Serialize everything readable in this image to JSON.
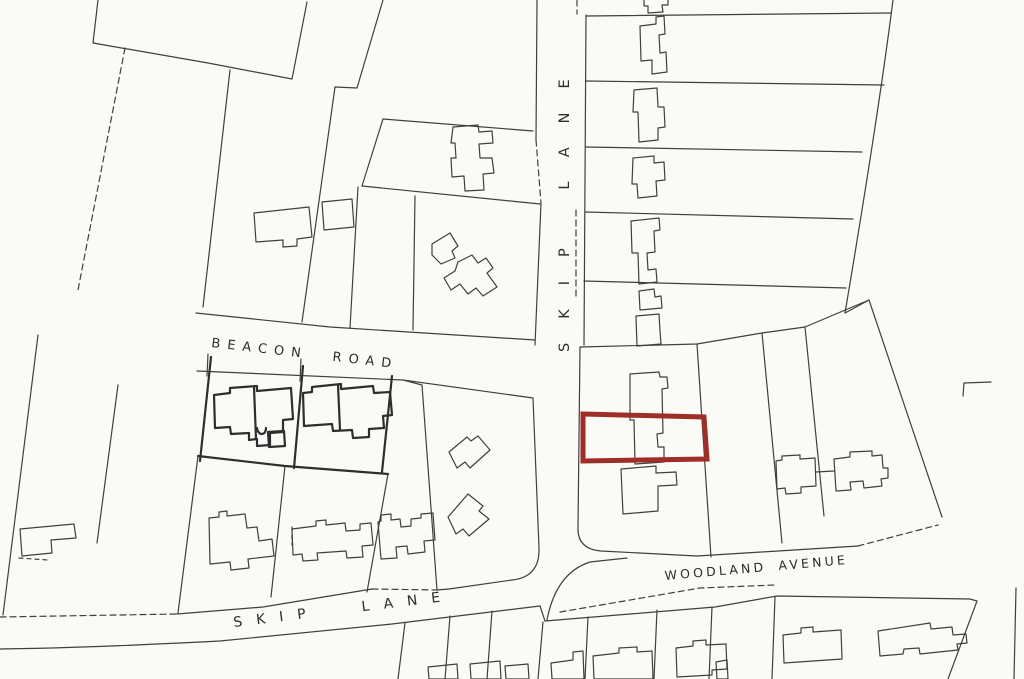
{
  "canvas": {
    "background": "#FAFAF7",
    "line_color": "#3F3F3F",
    "width": 1024,
    "height": 679
  },
  "streets": {
    "skip_lane_vertical": "SKIP LANE",
    "beacon_road": "BEACON ROAD",
    "skip_lane_bottom": "SKIP LANE",
    "woodland_avenue": "WOODLAND AVENUE"
  },
  "site_boundary": {
    "color": "#9E2F28"
  }
}
